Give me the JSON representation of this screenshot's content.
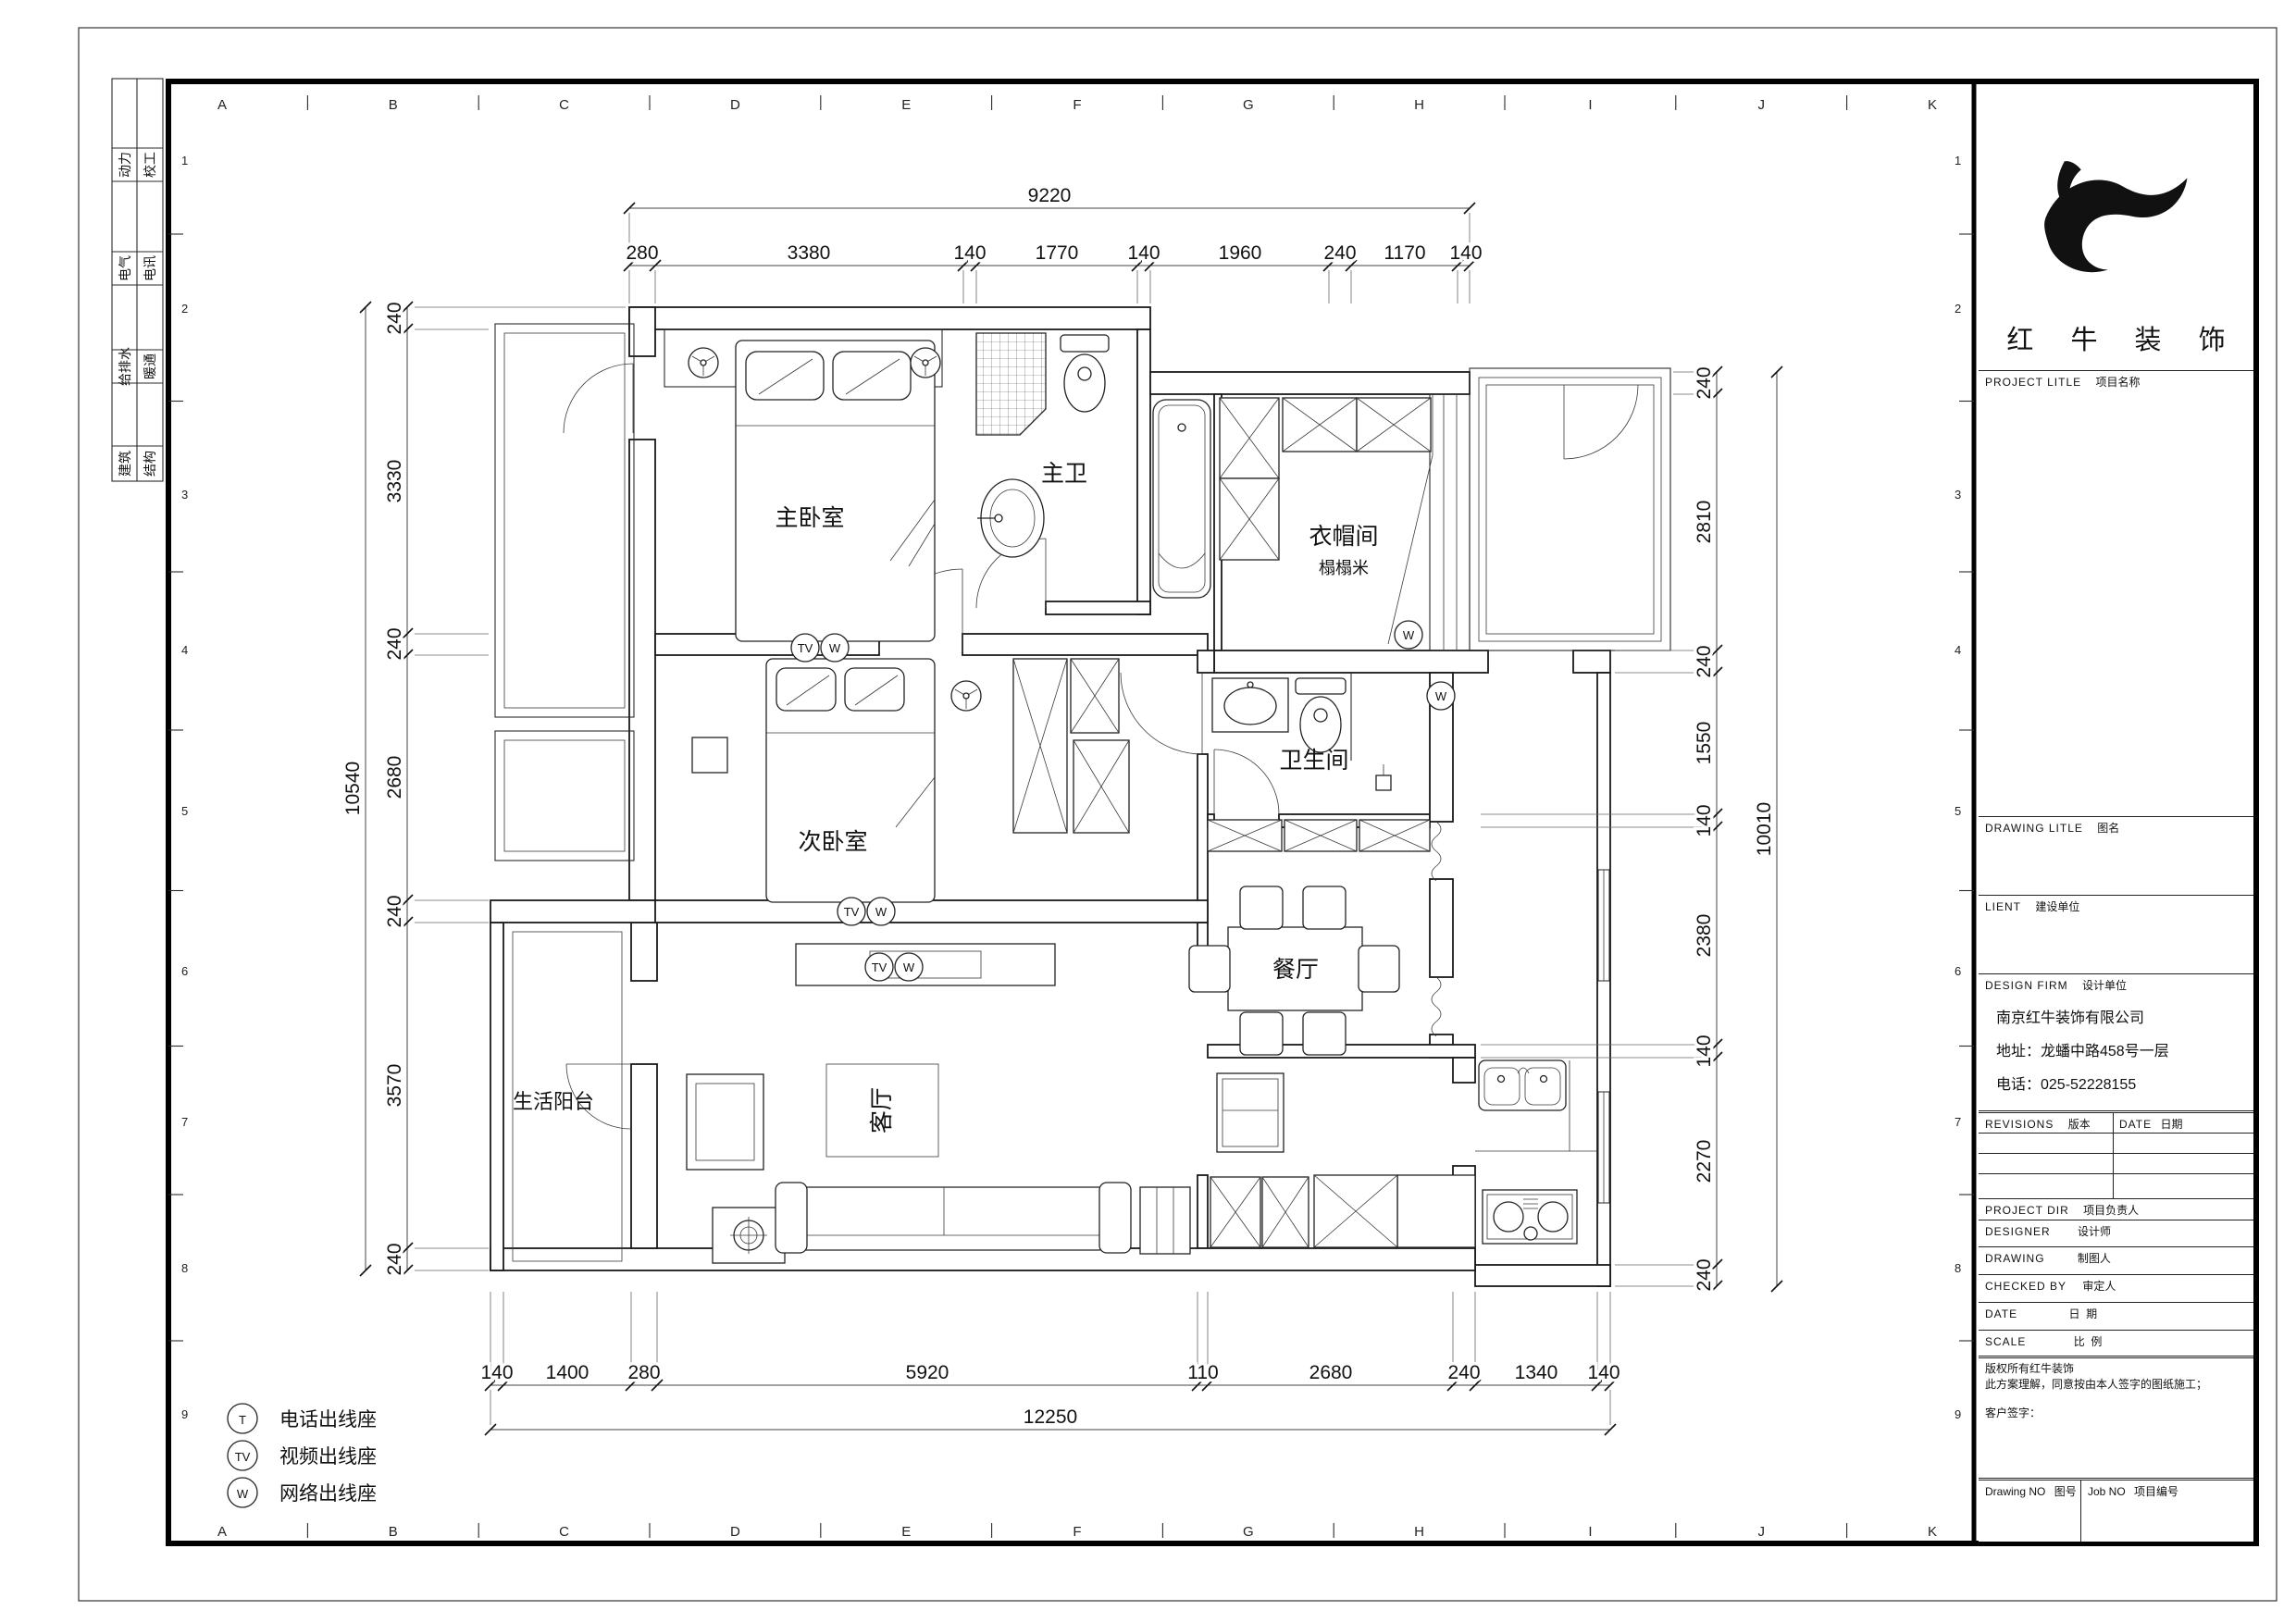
{
  "sheet": {
    "company_logo_name": "红 牛 装 饰",
    "grid_letters": [
      "A",
      "B",
      "C",
      "D",
      "E",
      "F",
      "G",
      "H",
      "I",
      "J",
      "K"
    ],
    "grid_numbers": [
      "1",
      "2",
      "3",
      "4",
      "5",
      "6",
      "7",
      "8",
      "9"
    ],
    "disciplines": [
      "动力",
      "校工",
      "电气",
      "电讯",
      "给排水",
      "暖通",
      "建筑",
      "结构"
    ]
  },
  "title_block": {
    "project_title_en": "PROJECT LITLE",
    "project_title_zh": "项目名称",
    "drawing_title_en": "DRAWING LITLE",
    "drawing_title_zh": "图名",
    "client_en": "LIENT",
    "client_zh": "建设单位",
    "design_firm_en": "DESIGN FIRM",
    "design_firm_zh": "设计单位",
    "firm_name": "南京红牛装饰有限公司",
    "firm_address": "地址：龙蟠中路458号一层",
    "firm_phone": "电话：025-52228155",
    "revisions_en": "REVISIONS",
    "revisions_zh": "版本",
    "date_col_en": "DATE",
    "date_col_zh": "日期",
    "project_dir_en": "PROJECT DIR",
    "project_dir_zh": "项目负责人",
    "designer_en": "DESIGNER",
    "designer_zh": "设计师",
    "drawing_by_en": "DRAWING",
    "drawing_by_zh": "制图人",
    "checked_by_en": "CHECKED BY",
    "checked_by_zh": "审定人",
    "date_row_en": "DATE",
    "date_row_zh": "日  期",
    "scale_row_en": "SCALE",
    "scale_row_zh": "比  例",
    "copyright_line1": "版权所有红牛装饰",
    "copyright_line2": "此方案理解，同意按由本人签字的图纸施工；",
    "client_sign": "客户签字：",
    "drawing_no_en": "Drawing NO",
    "drawing_no_zh": "图号",
    "job_no_en": "Job NO",
    "job_no_zh": "项目编号"
  },
  "legend": {
    "items": [
      {
        "symbol": "T",
        "label": "电话出线座"
      },
      {
        "symbol": "TV",
        "label": "视频出线座"
      },
      {
        "symbol": "W",
        "label": "网络出线座"
      }
    ]
  },
  "rooms": {
    "master_bedroom": "主卧室",
    "master_bath": "主卫",
    "cloakroom": "衣帽间",
    "cloakroom_sub": "榻榻米",
    "second_bedroom": "次卧室",
    "bathroom": "卫生间",
    "dining": "餐厅",
    "living": "客厅",
    "balcony": "生活阳台"
  },
  "outlets": {
    "tv": "TV",
    "w": "W",
    "t": "T"
  },
  "dims": {
    "top_total": "9220",
    "top_segments": [
      "280",
      "3380",
      "140",
      "1770",
      "140",
      "1960",
      "240",
      "1170",
      "140"
    ],
    "bottom_segments": [
      "140",
      "1400",
      "280",
      "5920",
      "110",
      "2680",
      "240",
      "1340",
      "140"
    ],
    "bottom_total": "12250",
    "left_total": "10540",
    "left_segments": [
      "240",
      "3330",
      "240",
      "2680",
      "240",
      "3570",
      "240"
    ],
    "right_segments": [
      "240",
      "2810",
      "240",
      "1550",
      "140",
      "2380",
      "140",
      "2270",
      "240"
    ],
    "right_total": "10010"
  }
}
